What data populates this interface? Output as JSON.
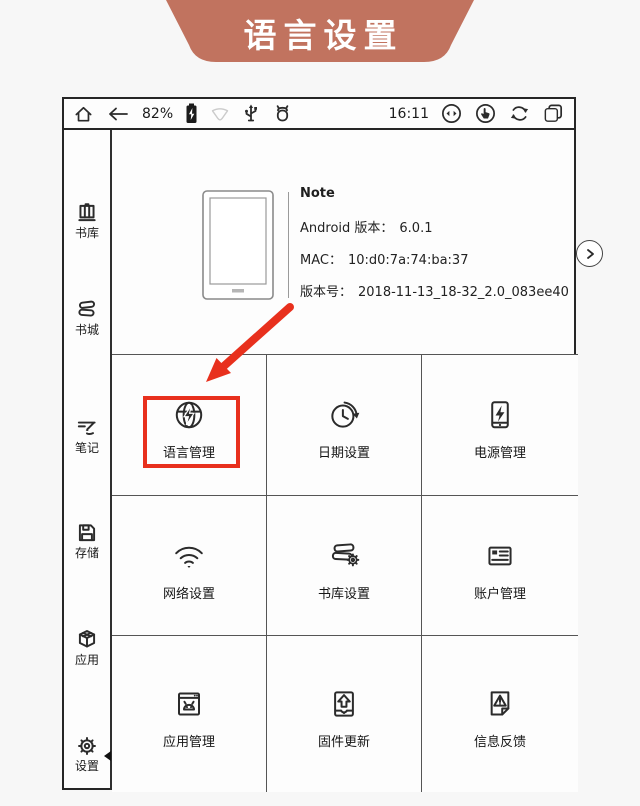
{
  "banner": {
    "title": "语言设置",
    "bg_color": "#c1735f"
  },
  "status_bar": {
    "battery_percent": "82%",
    "time": "16:11",
    "left_icons": [
      "home-icon",
      "back-arrow-icon",
      "battery-icon",
      "wifi-icon",
      "usb-icon",
      "android-icon"
    ],
    "right_icons": [
      "ab-contrast-icon",
      "touch-hand-icon",
      "sync-icon",
      "recents-icon"
    ]
  },
  "sidebar": {
    "items": [
      {
        "label": "书库",
        "icon": "library-icon"
      },
      {
        "label": "书城",
        "icon": "bookstore-icon"
      },
      {
        "label": "笔记",
        "icon": "notes-icon"
      },
      {
        "label": "存储",
        "icon": "storage-icon"
      },
      {
        "label": "应用",
        "icon": "apps-icon"
      },
      {
        "label": "设置",
        "icon": "settings-icon",
        "selected": true
      }
    ]
  },
  "device_info": {
    "model": "Note",
    "rows": [
      {
        "label": "Android 版本：",
        "value": "6.0.1"
      },
      {
        "label": "MAC：",
        "value": "10:d0:7a:74:ba:37"
      },
      {
        "label": "版本号：",
        "value": "2018-11-13_18-32_2.0_083ee40"
      }
    ]
  },
  "grid": {
    "tiles": [
      {
        "label": "语言管理",
        "icon": "globe-language-icon",
        "highlighted": true
      },
      {
        "label": "日期设置",
        "icon": "clock-history-icon"
      },
      {
        "label": "电源管理",
        "icon": "battery-power-icon"
      },
      {
        "label": "网络设置",
        "icon": "wifi-icon"
      },
      {
        "label": "书库设置",
        "icon": "books-gear-icon"
      },
      {
        "label": "账户管理",
        "icon": "id-card-icon"
      },
      {
        "label": "应用管理",
        "icon": "android-window-icon"
      },
      {
        "label": "固件更新",
        "icon": "firmware-upload-icon"
      },
      {
        "label": "信息反馈",
        "icon": "feedback-doc-icon"
      }
    ]
  },
  "annotation": {
    "highlight_color": "#e8301d"
  }
}
